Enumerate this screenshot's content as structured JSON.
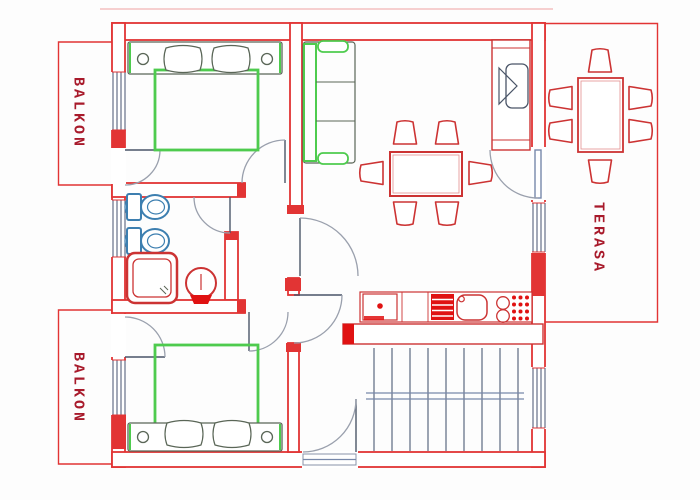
{
  "plan": {
    "labels": {
      "balcony_top": "BALKON",
      "balcony_bottom": "BALKON",
      "terrace": "TERASA"
    },
    "colors": {
      "wall_red": "#e23434",
      "label_red": "#a81a2b",
      "furniture_green": "#4ecb4e",
      "fixture_blue": "#3d7fb0",
      "kitchen_red": "#cc3333",
      "fill_red": "#e01212",
      "detail_gray": "#9aa0ad",
      "line_dark": "#4a5568",
      "background": "#fdfdfd"
    }
  }
}
